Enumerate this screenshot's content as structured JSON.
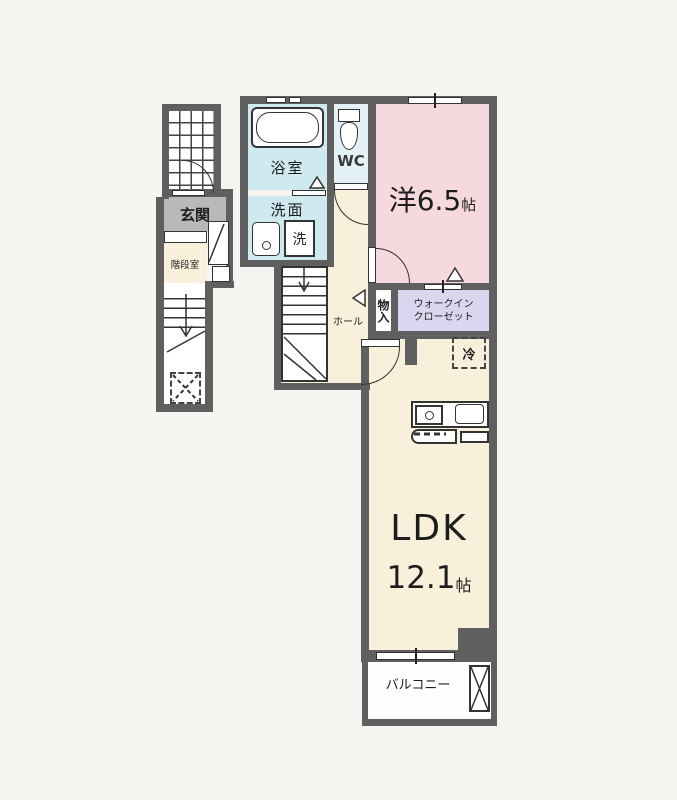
{
  "title": "apartment-floor-plan",
  "colors": {
    "background": "#f6f5f1",
    "wall": "#5f5f5f",
    "line": "#333333",
    "room_western": "#f6d9de",
    "room_ldk": "#f8f0da",
    "room_bath": "#cfe9f1",
    "room_wc": "#e4f2f7",
    "room_wic": "#d9d7ef",
    "room_genkan_tile": "#b9b9b9",
    "room_white": "#fefefe"
  },
  "labels": {
    "genkan": "玄関",
    "stair_room": "階段室",
    "bath": "浴室",
    "washroom": "洗面",
    "washer": "洗",
    "wc": "WC",
    "western_room": "洋6.5",
    "western_room_unit": "帖",
    "hall": "ホール",
    "closet": "物入",
    "wic_line1": "ウォークイン",
    "wic_line2": "クローゼット",
    "fridge": "冷",
    "ldk": "LDK",
    "ldk_size": "12.1",
    "ldk_unit": "帖",
    "balcony": "バルコニー"
  }
}
